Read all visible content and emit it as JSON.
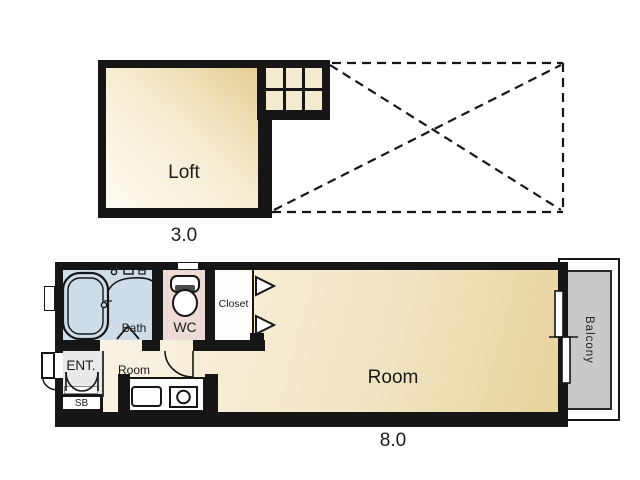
{
  "plan": {
    "upper": {
      "loft_label": "Loft",
      "loft_area": "3.0"
    },
    "lower": {
      "room_label": "Room",
      "room_area": "8.0",
      "bath_line1": "Bath",
      "bath_line2": "Room",
      "wc_label": "WC",
      "closet_label": "Closet",
      "entrance_label": "ENT.",
      "shoe_box_label": "SB",
      "balcony_label": "Balcony"
    }
  },
  "colors": {
    "wall": "#161616",
    "floor_light": "#fbf6ea",
    "floor_gold": "#e6cf95",
    "bath_floor": "#cfdde9",
    "wc_floor": "#eedbd8",
    "closet_floor": "#fdfdfb",
    "entrance_floor": "#e9e9e7",
    "balcony_floor": "#c9c9c9"
  }
}
